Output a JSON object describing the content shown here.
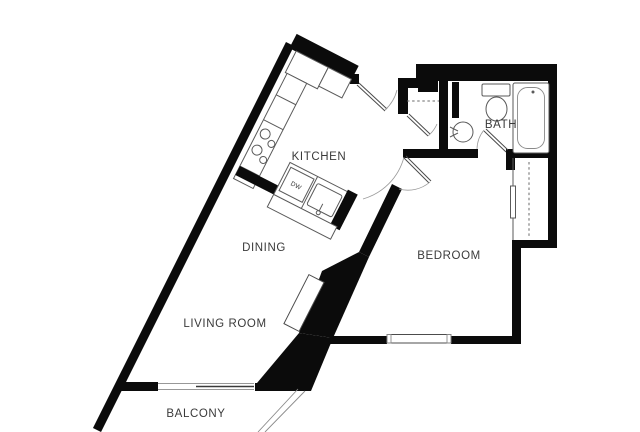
{
  "title": "Apartment floor plan",
  "colors": {
    "background": "#ffffff",
    "walls": "#0b0b0b",
    "fixture_lines": "#5a5a5a",
    "label_text": "#3a3a3a"
  },
  "rooms": {
    "kitchen": {
      "label": "KITCHEN"
    },
    "dining": {
      "label": "DINING"
    },
    "living": {
      "label": "LIVING ROOM"
    },
    "bedroom": {
      "label": "BEDROOM"
    },
    "bath": {
      "label": "BATH"
    },
    "balcony": {
      "label": "BALCONY"
    }
  },
  "appliances": {
    "dishwasher_label": "DW"
  },
  "icons": [
    "refrigerator-icon",
    "range-burners-icon",
    "kitchen-sink-icon",
    "dishwasher-icon",
    "toilet-icon",
    "bathroom-sink-icon",
    "bathtub-icon",
    "entry-door-icon",
    "closet-door-icon",
    "bedroom-door-icon",
    "bath-door-icon",
    "entry-closet-shelf-icon",
    "bedroom-closet-rod-icon",
    "sliding-closet-door-icon",
    "living-room-window-icon",
    "bedroom-window-icon",
    "balcony-railing-icon",
    "media-console-icon"
  ]
}
